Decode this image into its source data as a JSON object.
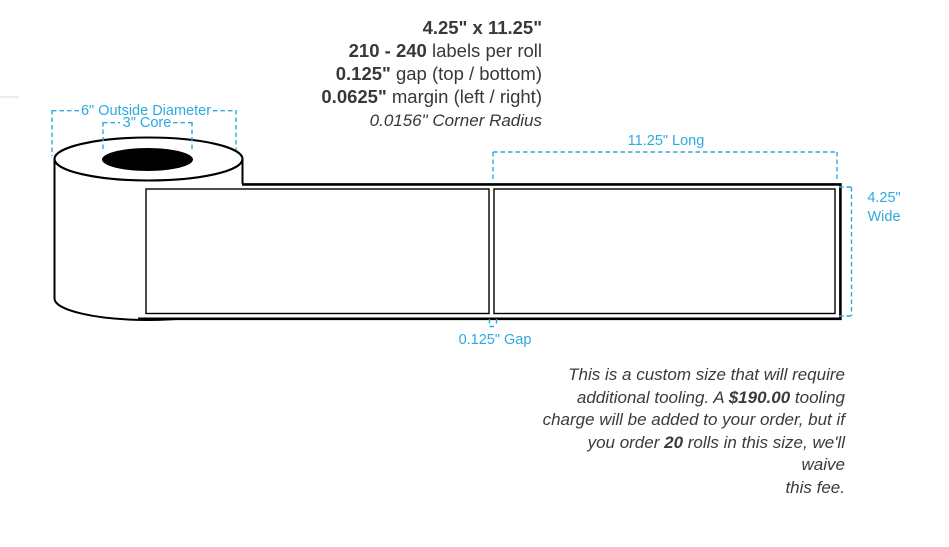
{
  "colors": {
    "accent_blue": "#2ea9e0",
    "ink": "#383838",
    "drawing_line": "#000000"
  },
  "specs": {
    "lines": [
      [
        {
          "t": "4.25\" x 11.25\"",
          "b": 1
        }
      ],
      [
        {
          "t": "210 - 240",
          "b": 1
        },
        {
          "t": " labels per roll"
        }
      ],
      [
        {
          "t": "0.125\"",
          "b": 1
        },
        {
          "t": " gap (top / bottom)"
        }
      ],
      [
        {
          "t": "0.0625\"",
          "b": 1
        },
        {
          "t": " margin (left / right)"
        }
      ],
      [
        {
          "t": "0.0156\" Corner Radius",
          "i": 1
        }
      ]
    ]
  },
  "roll": {
    "outside_diameter_label": "6\" Outside Diameter",
    "core_label": "3\" Core"
  },
  "dimensions": {
    "long_label": "11.25\" Long",
    "wide_value": "4.25\"",
    "wide_word": "Wide",
    "gap_label": "0.125\" Gap"
  },
  "tooling_note": {
    "lines": [
      [
        {
          "t": "This is a custom size that will require"
        }
      ],
      [
        {
          "t": "additional tooling. A "
        },
        {
          "t": "$190.00",
          "b": 1
        },
        {
          "t": " tooling"
        }
      ],
      [
        {
          "t": "charge will be added to your order, but if"
        }
      ],
      [
        {
          "t": "you order "
        },
        {
          "t": "20",
          "b": 1
        },
        {
          "t": " rolls in this size, we'll waive"
        }
      ],
      [
        {
          "t": "this fee."
        }
      ]
    ]
  }
}
